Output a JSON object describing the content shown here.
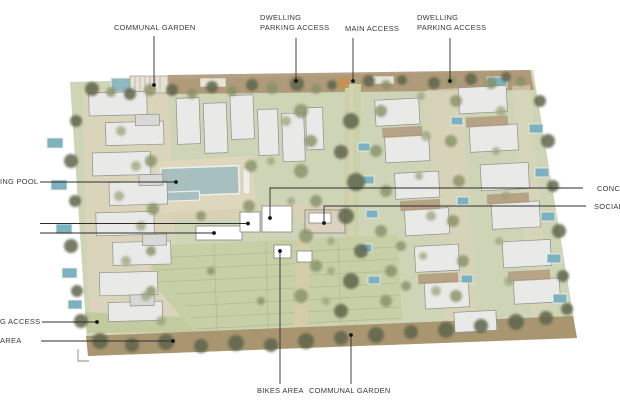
{
  "palette": {
    "site_green": "#ced4b6",
    "parking_green": "#c7cfa6",
    "path_beige": "#dbd2b8",
    "garden_brown": "#a98f6f",
    "road_brown": "#a6926d",
    "pool_teal": "#a7bfbf",
    "mini_pool_teal": "#7cb2bf",
    "building_fill": "#e9e9e7",
    "building_stroke": "#8f8f8c",
    "tree_dark": "#5e644a",
    "tree_mid": "#879066",
    "tree_light": "#9da57d",
    "label_color": "#3a3a3a",
    "leader_color": "#2d2d2d"
  },
  "annotations": {
    "communal_garden_top": "COMMUNAL GARDEN",
    "dwelling_parking_access_left": {
      "line1": "DWELLING",
      "line2": "PARKING ACCESS"
    },
    "main_access": "MAIN ACCESS",
    "dwelling_parking_access_right": {
      "line1": "DWELLING",
      "line2": "PARKING ACCESS"
    },
    "swimming_pool_truncated": "ING POOL",
    "concierge_truncated": "CONC",
    "social_truncated": "SOCIAL",
    "parking_access_truncated": "G ACCESS",
    "parking_area_truncated": "AREA",
    "bikes_area": "BIKES AREA",
    "communal_garden_bottom": "COMMUNAL GARDEN"
  }
}
